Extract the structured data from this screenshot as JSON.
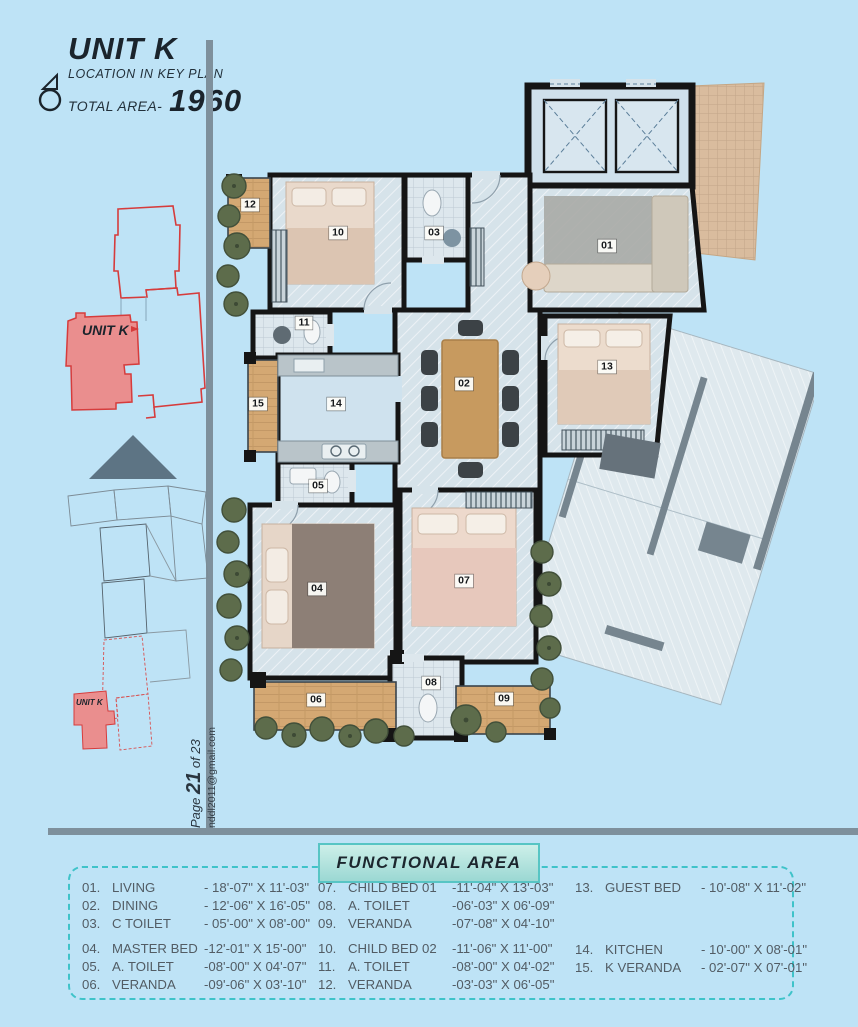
{
  "header": {
    "unit_title": "UNIT K",
    "key_plan_caption": "LOCATION IN KEY PLAN",
    "total_area_label": "TOTAL AREA-",
    "total_area_value": "1960"
  },
  "key_plan": {
    "unit_label": "UNIT K"
  },
  "site_plan": {
    "unit_label": "UNIT K"
  },
  "sidebar": {
    "page_word": "Page ",
    "page_number": "21",
    "page_total": " of 23",
    "email": "nddl2011@gmail.com"
  },
  "plan": {
    "labels": [
      "01",
      "02",
      "03",
      "04",
      "05",
      "06",
      "07",
      "08",
      "09",
      "10",
      "11",
      "12",
      "13",
      "14",
      "15"
    ]
  },
  "functional_area": {
    "title": "FUNCTIONAL AREA",
    "col1": [
      {
        "num": "01.",
        "name": "LIVING",
        "dim": "-  18'-07\" X 11'-03\""
      },
      {
        "num": "02.",
        "name": "DINING",
        "dim": "-  12'-06\" X 16'-05\""
      },
      {
        "num": "03.",
        "name": "C TOILET",
        "dim": "-  05'-00\" X 08'-00\""
      },
      {
        "num": "04.",
        "name": "MASTER BED",
        "dim": "-12'-01\" X 15'-00\""
      },
      {
        "num": "05.",
        "name": "A. TOILET",
        "dim": "-08'-00\" X 04'-07\""
      },
      {
        "num": "06.",
        "name": "VERANDA",
        "dim": "-09'-06\" X 03'-10\""
      }
    ],
    "col2": [
      {
        "num": "07.",
        "name": "CHILD BED 01",
        "dim": "-11'-04\" X 13'-03\""
      },
      {
        "num": "08.",
        "name": "A. TOILET",
        "dim": "-06'-03\" X 06'-09\""
      },
      {
        "num": "09.",
        "name": "VERANDA",
        "dim": "-07'-08\" X 04'-10\""
      },
      {
        "num": "10.",
        "name": "CHILD BED 02",
        "dim": "-11'-06\" X 11'-00\""
      },
      {
        "num": "11.",
        "name": "A. TOILET",
        "dim": "-08'-00\" X 04'-02\""
      },
      {
        "num": "12.",
        "name": "VERANDA",
        "dim": "-03'-03\" X 06'-05\""
      }
    ],
    "col3": [
      {
        "num": "13.",
        "name": "GUEST BED",
        "dim": "-  10'-08\" X 11'-02\""
      },
      {
        "num": "14.",
        "name": "KITCHEN",
        "dim": "-  10'-00\" X 08'-01\""
      },
      {
        "num": "15.",
        "name": "K VERANDA",
        "dim": "-  02'-07\" X 07'-01\""
      }
    ]
  },
  "colors": {
    "background": "#bee3f6",
    "unit_highlight_fill": "#ea8e8e",
    "unit_outline_red": "#d63c3c",
    "divider_slate": "#7e909c",
    "teal_dashed_border": "#3fc3c9",
    "wall_black": "#151515",
    "veranda_wood": "#d4a873"
  }
}
